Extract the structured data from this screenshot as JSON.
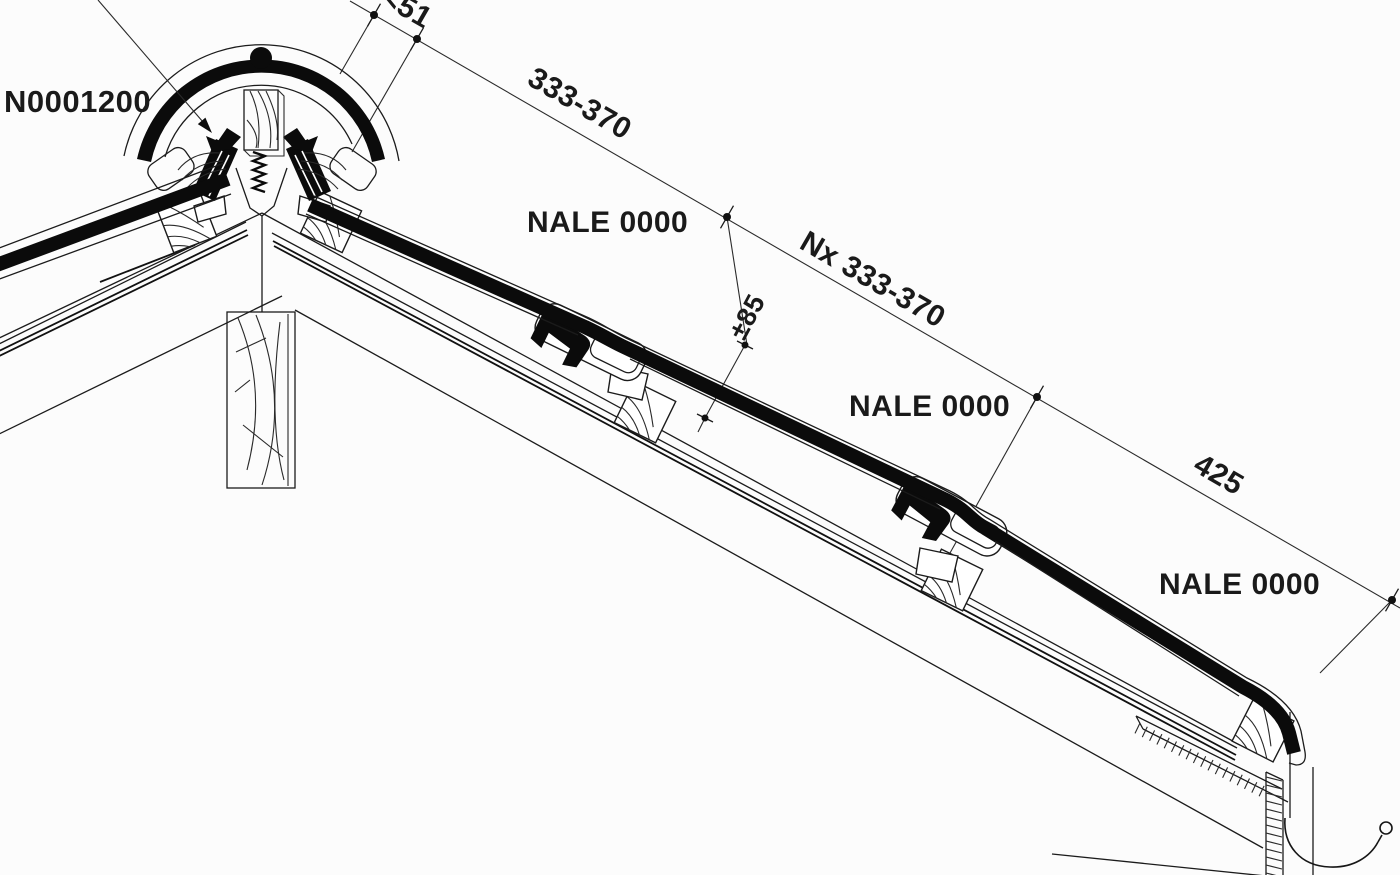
{
  "page": {
    "title": "Roof ridge and tiling section detail",
    "background": "#fcfcfc",
    "ink_color": "#141414"
  },
  "labels": {
    "part_number": "N0001200",
    "tile_name_1": "NALE 0000",
    "tile_name_2": "NALE 0000",
    "tile_name_3": "NALE 0000"
  },
  "dimensions": {
    "ridge_gap": "<51",
    "batten_spacing": "333-370",
    "batten_spacing_repeat": "Nx 333-370",
    "head_overlap_tolerance": "±85",
    "eave_batten_distance": "425"
  }
}
